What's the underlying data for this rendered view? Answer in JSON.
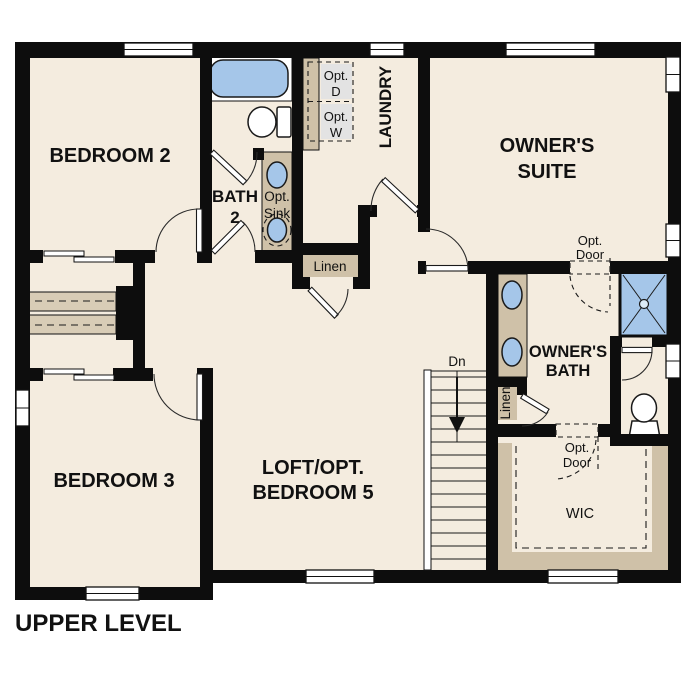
{
  "level_title": "UPPER LEVEL",
  "colors": {
    "wall": "#0d0d0d",
    "floor": "#f4ecdf",
    "accent_tan": "#cfc1a8",
    "shelf_tan": "#d8ccb6",
    "fixture_blue": "#a5c6e9",
    "optional_gray": "#e3e3e3",
    "background": "#ffffff"
  },
  "rooms": {
    "bedroom2": "BEDROOM 2",
    "bedroom3": "BEDROOM 3",
    "bath2": [
      "BATH",
      "2"
    ],
    "laundry": "LAUNDRY",
    "owners_suite": [
      "OWNER'S",
      "SUITE"
    ],
    "owners_bath": [
      "OWNER'S",
      "BATH"
    ],
    "loft": [
      "LOFT/OPT.",
      "BEDROOM 5"
    ],
    "wic": "WIC"
  },
  "features": {
    "opt_sink": [
      "Opt.",
      "Sink"
    ],
    "opt_dryer": [
      "Opt.",
      "D"
    ],
    "opt_washer": [
      "Opt.",
      "W"
    ],
    "linen_hall": "Linen",
    "linen_owners": "Linen",
    "opt_door_suite": [
      "Opt.",
      "Door"
    ],
    "opt_door_wic": [
      "Opt.",
      "Door"
    ],
    "stair_direction": "Dn"
  }
}
